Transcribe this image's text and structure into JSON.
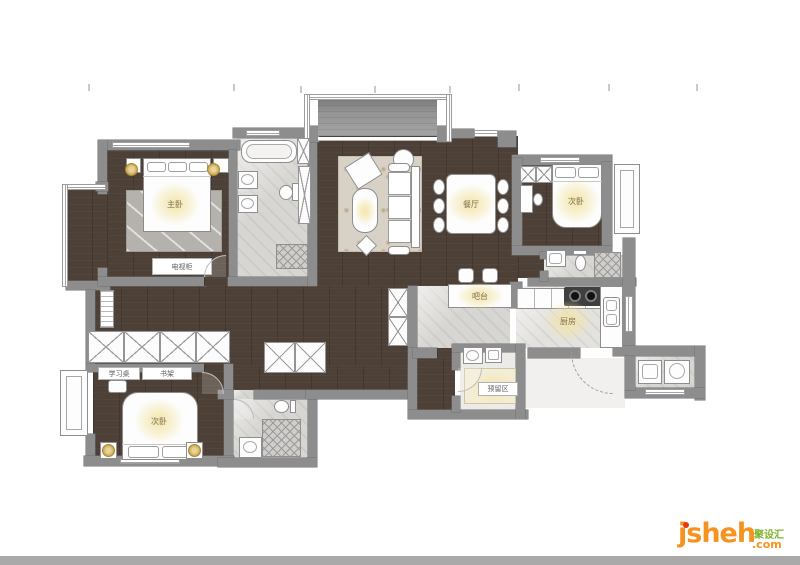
{
  "plan_type": "apartment-floor-plan",
  "labels": {
    "master_bedroom": "主卧",
    "tv_cabinet": "电视柜",
    "dining": "餐厅",
    "bedroom_top_right": "次卧",
    "bedroom_bottom_left": "次卧",
    "bar": "吧台",
    "kitchen": "厨房",
    "reserved": "预留区",
    "desk": "学习桌",
    "bookshelf": "书架"
  },
  "logo": {
    "brand": "jsheh",
    "tld": ".com",
    "chinese": "聚设汇",
    "brand_color": "#f6921e",
    "chinese_color": "#7cb52b",
    "dot_color": "#e8380d"
  },
  "colors": {
    "wall": "#8d8d8d",
    "wood_floor": "#4d4036",
    "tile_floor": "#d8d6d2",
    "glow": "#f3e5a8",
    "footer_bar": "#a9a9a9"
  }
}
